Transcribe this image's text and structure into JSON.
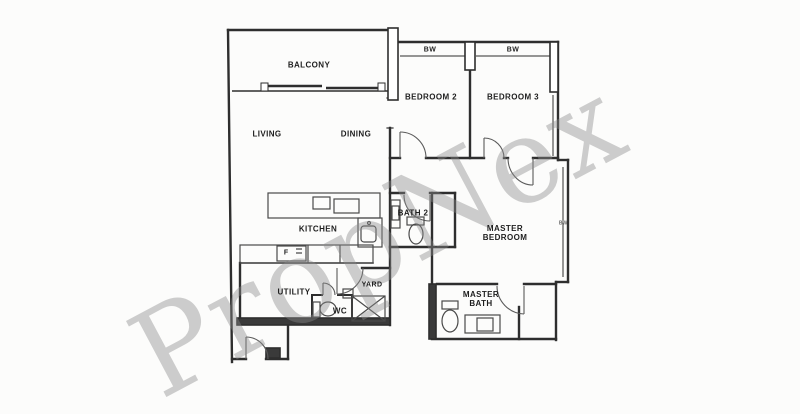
{
  "watermark": "PropNex",
  "colors": {
    "wall_line": "#2e2e2e",
    "fixture_line": "#4a4a4a",
    "watermark_gray": "rgba(138,138,138,0.42)",
    "background": "#fcfcfb"
  },
  "rooms": {
    "balcony": {
      "label": "BALCONY"
    },
    "living": {
      "label": "LIVING"
    },
    "dining": {
      "label": "DINING"
    },
    "bedroom2": {
      "label": "BEDROOM 2"
    },
    "bedroom3": {
      "label": "BEDROOM 3"
    },
    "master_bedroom": {
      "line1": "MASTER",
      "line2": "BEDROOM"
    },
    "kitchen": {
      "label": "KITCHEN"
    },
    "bath2": {
      "label": "BATH 2"
    },
    "utility": {
      "label": "UTILITY"
    },
    "wc": {
      "label": "WC"
    },
    "yard": {
      "label": "YARD"
    },
    "master_bath": {
      "line1": "MASTER",
      "line2": "BATH"
    }
  },
  "annotations": {
    "bw_bedroom2": "BW",
    "bw_bedroom3": "BW",
    "bw_master": "BW",
    "fridge": "F"
  }
}
